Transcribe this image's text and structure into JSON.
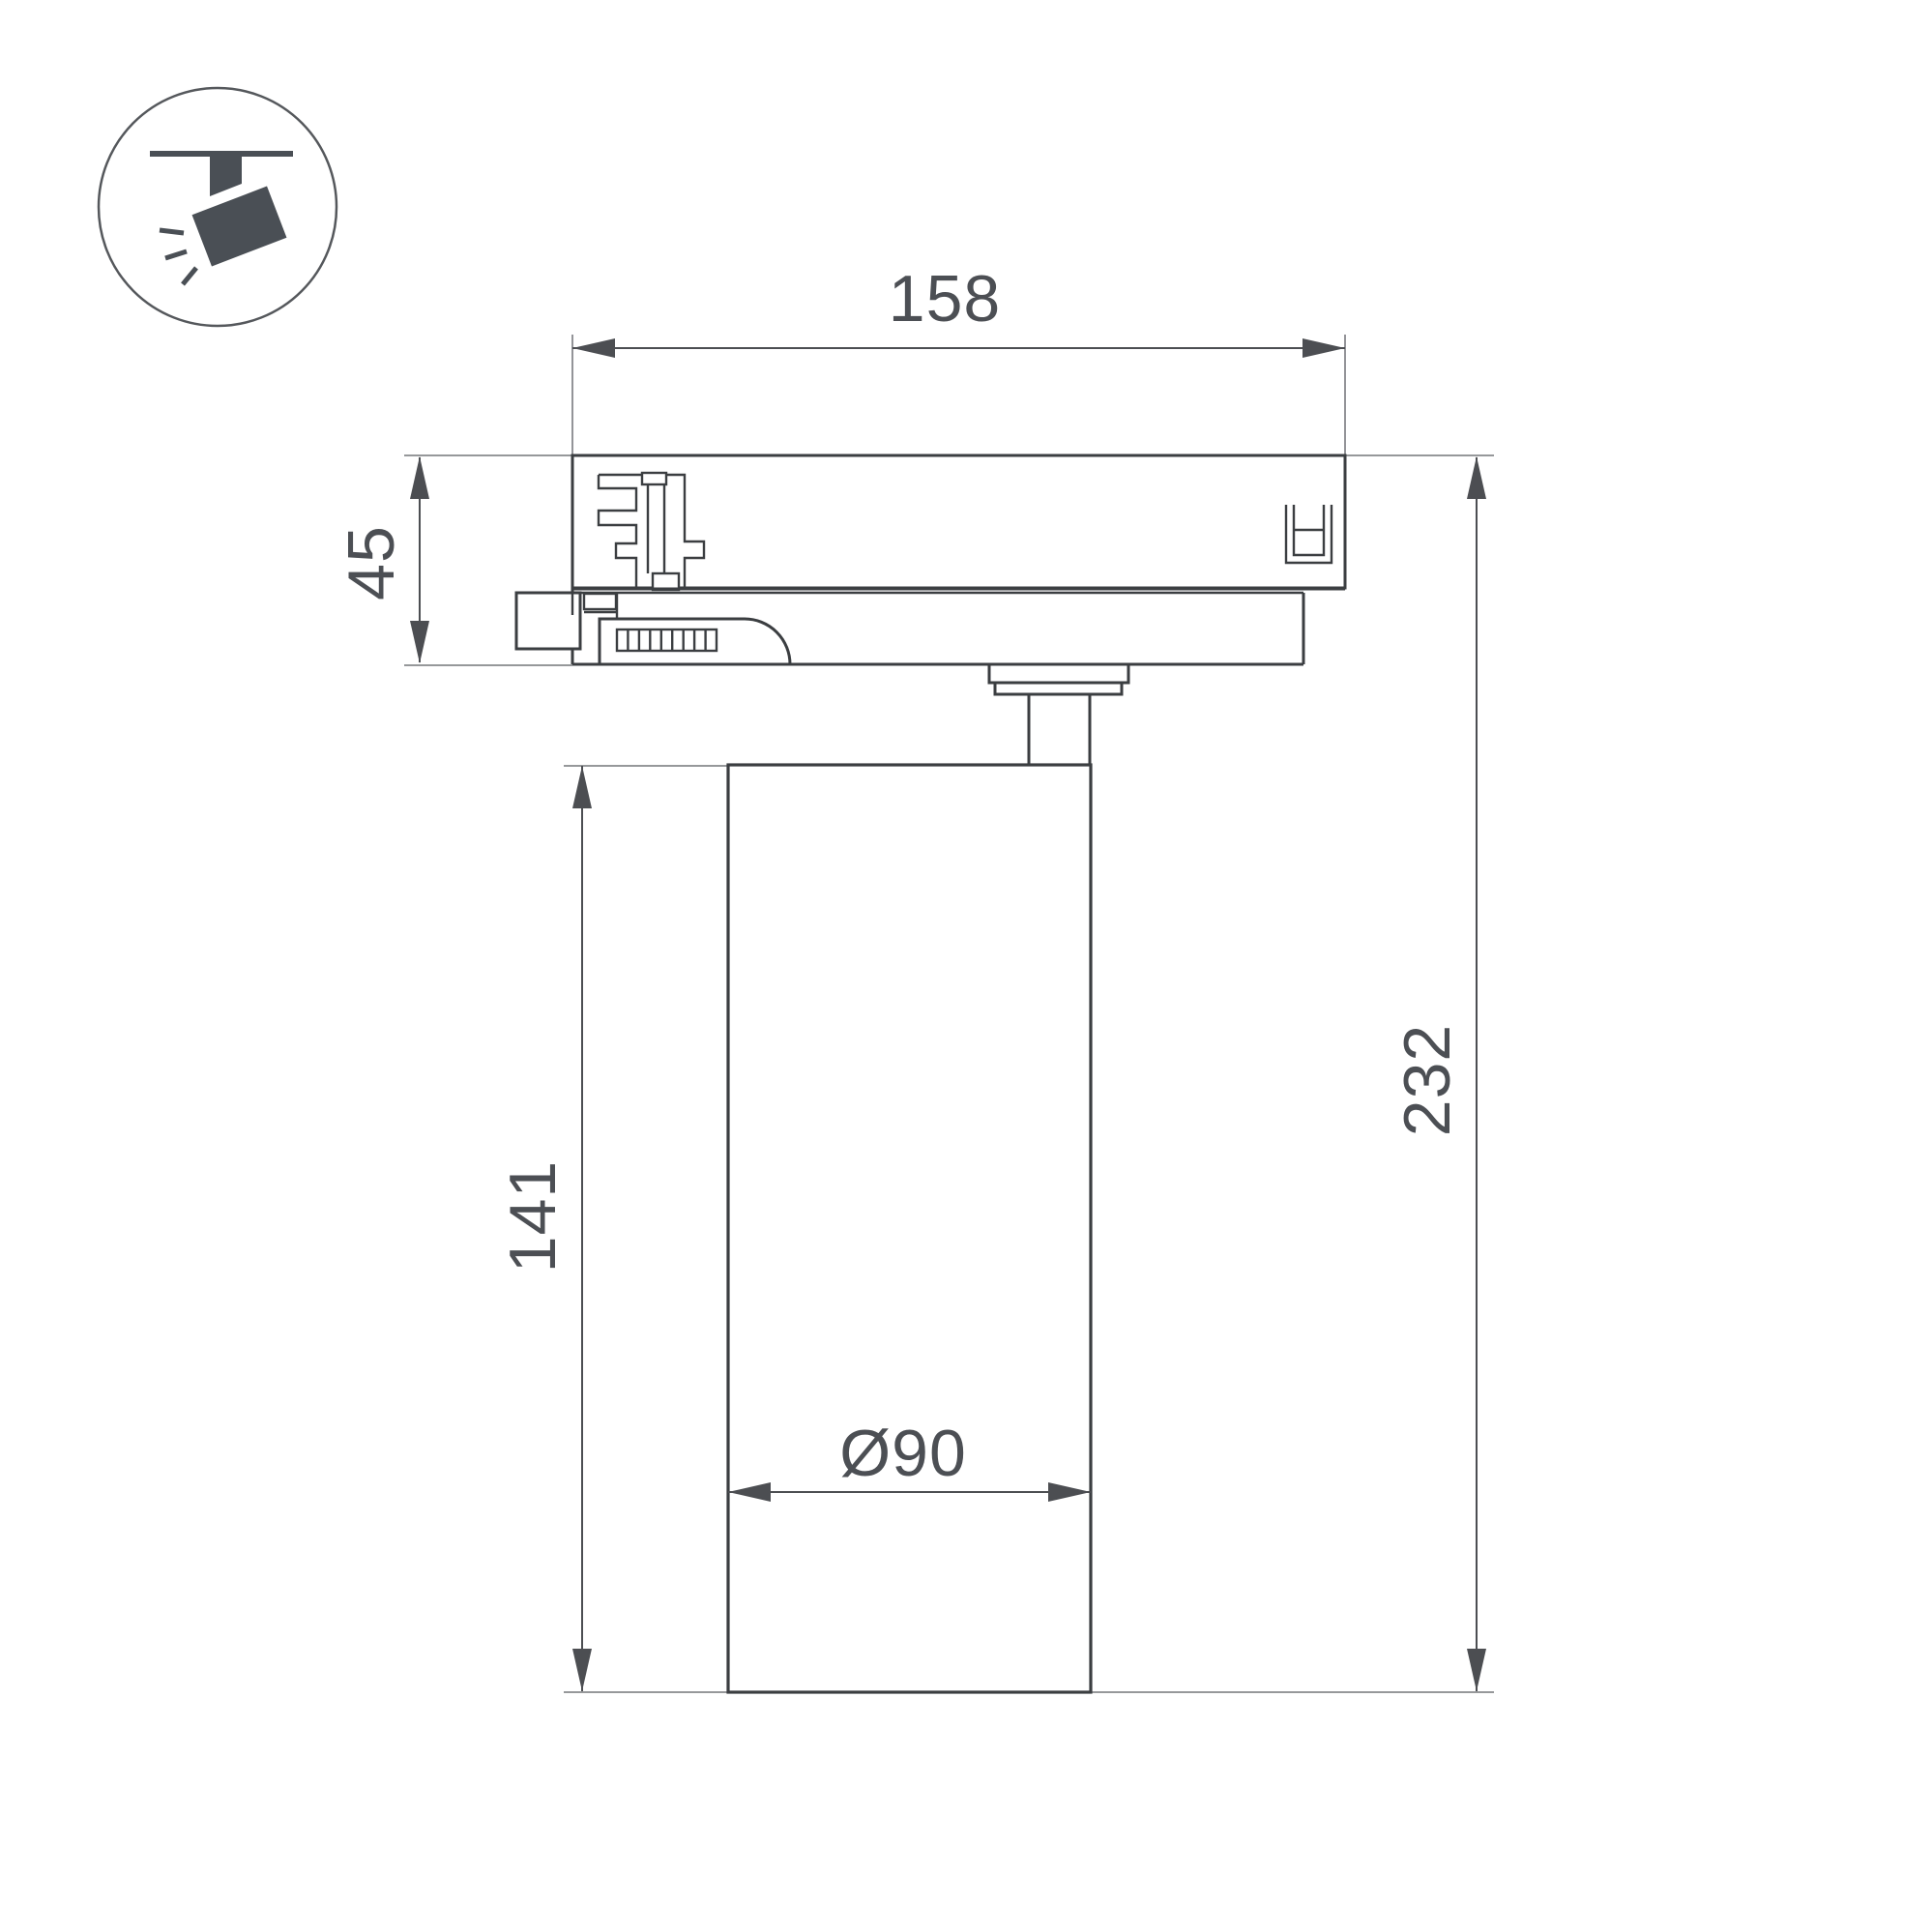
{
  "drawing": {
    "title": "track-spotlight-dimension-drawing",
    "icon": {
      "name": "track-spotlight-icon"
    },
    "dimensions": {
      "top_width": "158",
      "adapter_height": "45",
      "body_height": "141",
      "overall_height": "232",
      "body_diameter": "Ø90"
    },
    "colors": {
      "outline": "#3b3e41",
      "dimension_line": "#4c4e52",
      "extension_line": "#87898c",
      "label_text": "#4c4f54",
      "icon": "#4a4f55",
      "background": "#ffffff"
    }
  }
}
